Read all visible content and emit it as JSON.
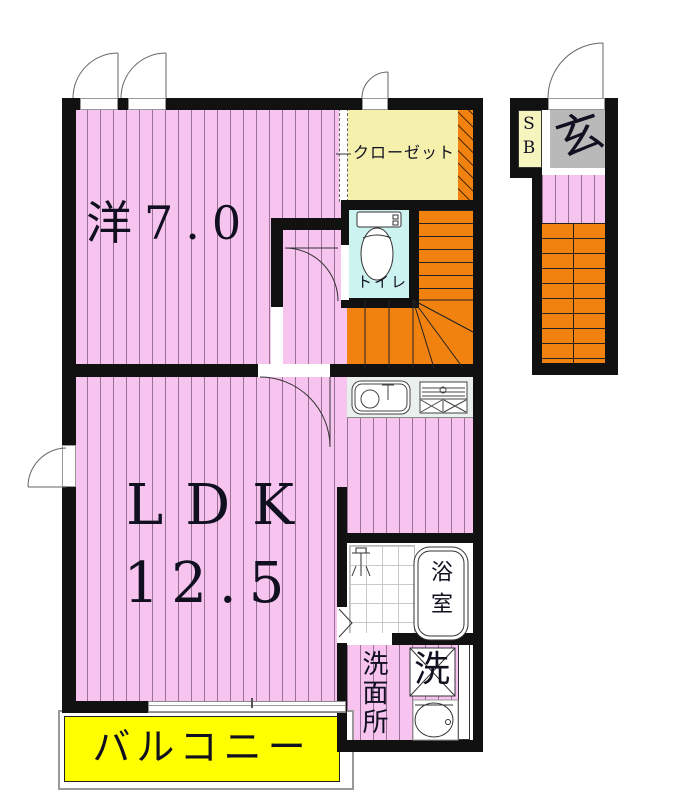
{
  "plan_title": "2F apartment floor plan",
  "rooms": {
    "western_room": {
      "label": "洋7.0"
    },
    "closet": {
      "label": "クローゼット"
    },
    "toilet": {
      "label": "トイレ"
    },
    "ldk": {
      "label": "LDK",
      "size": "12.5"
    },
    "bathroom": {
      "label": "浴室"
    },
    "washroom": {
      "label": "洗面所"
    },
    "laundry": {
      "label": "洗"
    },
    "balcony": {
      "label": "バルコニー"
    },
    "entrance": {
      "label": "玄"
    },
    "shoe_box": {
      "label": "SB"
    }
  },
  "colors": {
    "room_pink": "#F7C3EF",
    "stair_orange": "#F1820F",
    "closet_yellow": "#F5F1AD",
    "shoebox_yellow": "#F7F5BE",
    "balcony_yellow": "#FFFF00",
    "toilet_cyan": "#CDF3F1",
    "entrance_gray": "#B9B9B9",
    "wall_black": "#111111"
  }
}
